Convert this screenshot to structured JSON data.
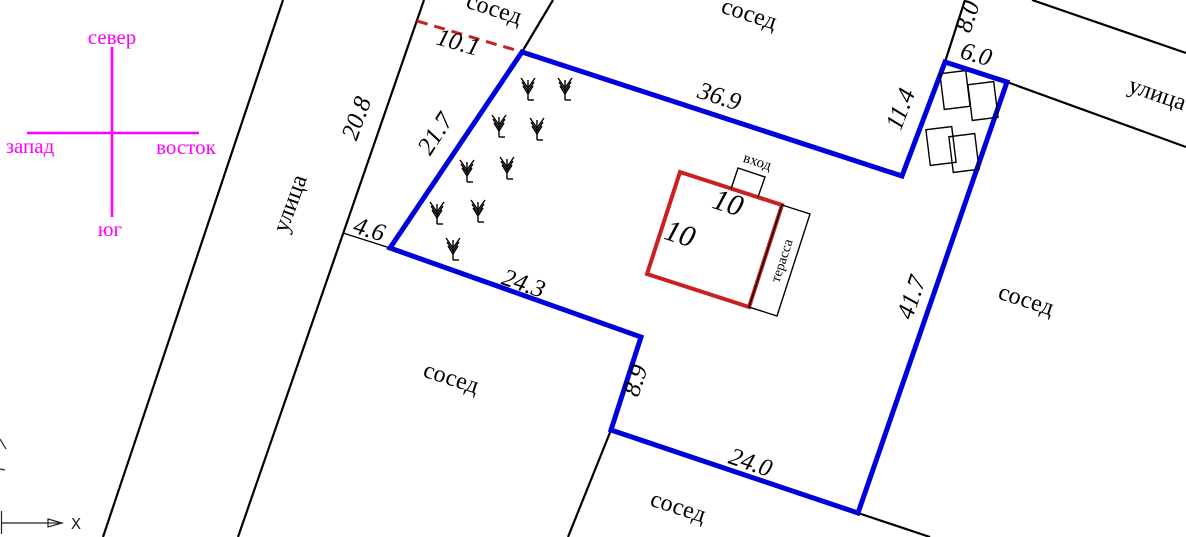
{
  "colors": {
    "boundary": "#0000dd",
    "house": "#cc1f1f",
    "dashed": "#cc1f1f",
    "compass": "#ff00ff",
    "line": "#000000"
  },
  "compass": {
    "north": "север",
    "south": "юг",
    "west": "запад",
    "east": "восток"
  },
  "streets": {
    "left": "улица",
    "right": "улица"
  },
  "neighbors": {
    "top_left": "сосед",
    "top": "сосед",
    "east": "сосед",
    "west": "сосед",
    "south": "сосед"
  },
  "dimensions": {
    "dashed_gap": "10.1",
    "street_frontage": "20.8",
    "edge_nw": "21.7",
    "connector_w": "4.6",
    "edge_sw": "24.3",
    "edge_n": "36.9",
    "edge_ne": "11.4",
    "edge_top_right": "6.0",
    "street_segment": "8.0",
    "edge_e": "41.7",
    "edge_step": "8.9",
    "edge_s": "24.0"
  },
  "house": {
    "width": "10",
    "depth": "10",
    "entrance_label": "вход",
    "terrace_label": "терасса"
  },
  "ucs": {
    "x_label": "X"
  }
}
